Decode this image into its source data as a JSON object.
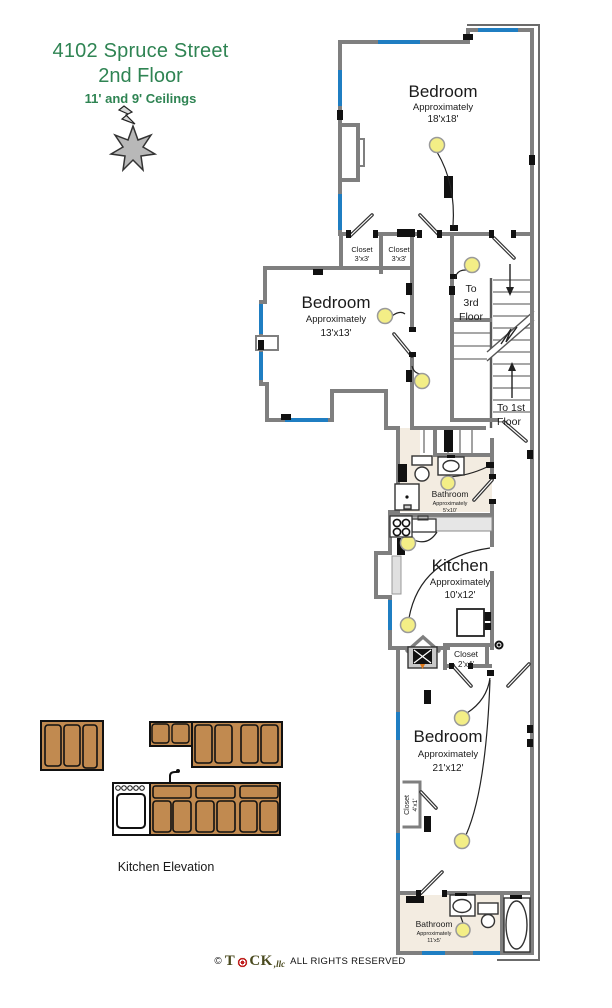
{
  "title": {
    "line1": "4102 Spruce Street",
    "line2": "2nd Floor",
    "line3": "11' and 9' Ceilings"
  },
  "rooms": {
    "bedroom_top": {
      "name": "Bedroom",
      "approx": "Approximately",
      "size": "18'x18'"
    },
    "bedroom_middle": {
      "name": "Bedroom",
      "approx": "Approximately",
      "size": "13'x13'"
    },
    "bedroom_bottom": {
      "name": "Bedroom",
      "approx": "Approximately",
      "size": "21'x12'"
    },
    "kitchen": {
      "name": "Kitchen",
      "approx": "Approximately",
      "size": "10'x12'"
    },
    "bathroom_upper": {
      "name": "Bathroom",
      "approx": "Approximately",
      "size": "5'x10'"
    },
    "bathroom_lower": {
      "name": "Bathroom",
      "approx": "Approximately",
      "size": "11'x5'"
    },
    "closet_a": {
      "name": "Closet",
      "size": "3'x3'"
    },
    "closet_b": {
      "name": "Closet",
      "size": "3'x3'"
    },
    "closet_c": {
      "name": "Closet",
      "size": "2'x4'"
    },
    "closet_d": {
      "name": "Closet",
      "size": "4'x1'"
    }
  },
  "stairs": {
    "to_3rd_line1": "To",
    "to_3rd_line2": "3rd",
    "to_3rd_line3": "Floor",
    "to_1st_line1": "To 1st",
    "to_1st_line2": "Floor"
  },
  "kitchen_elevation": {
    "label": "Kitchen Elevation"
  },
  "footer": {
    "copyright_symbol": "©",
    "brand_t": "T",
    "brand_ck": "CK",
    "brand_suffix": ",llc",
    "rights": "ALL RIGHTS RESERVED"
  },
  "legend_colors": {
    "window": "#1f7ec2",
    "ceiling_light": "#f3ee86",
    "cabinet": "#c18a50",
    "bath_floor": "#f3ece1",
    "wall": "#7f7f7f",
    "title_green": "#2f8453"
  }
}
